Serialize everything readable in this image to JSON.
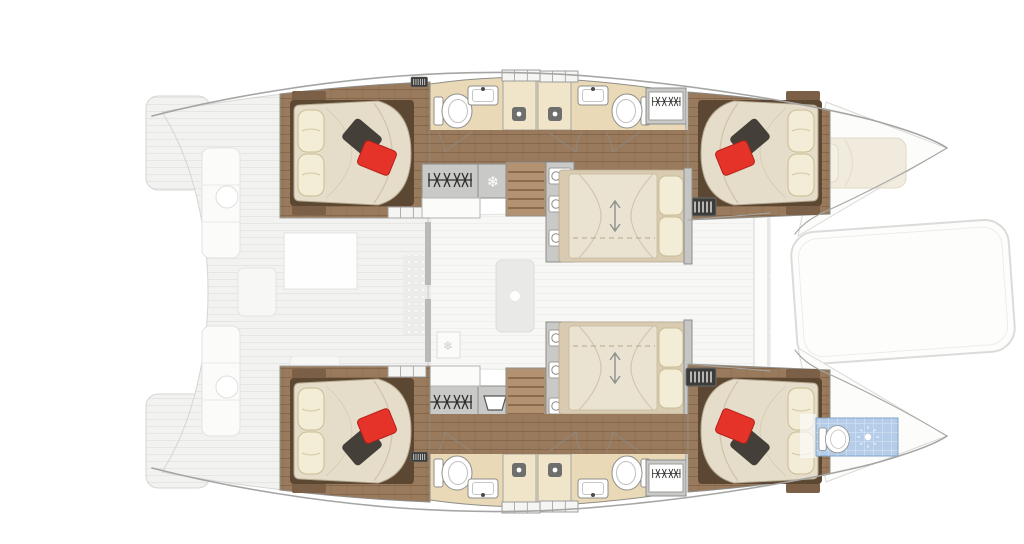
{
  "scene": {
    "type": "floorplan",
    "subject": "catamaran sailing yacht - overhead interior and deck layout plan",
    "orientation": "bow-right",
    "visible_inventory": {
      "double_cabins": 4,
      "accent_pillows_per_cabin": 2,
      "bathrooms": 4,
      "shower_stalls": 4,
      "toilets": 5,
      "sinks": 4,
      "center_berths": 2,
      "staircases": 2,
      "wardrobe_hanger_lockers": 4,
      "bow_berth": 1,
      "bow_wet_room": 1
    }
  },
  "icons": {
    "snowflake": "❄"
  },
  "colors": {
    "background": "#ffffff",
    "deck_fill": "#f2f2f1",
    "deck_fill_light": "#f7f7f6",
    "deck_stroke": "#d6d6d4",
    "deck_furniture": "#fbfbfa",
    "hull_outline": "#a5a5a3",
    "wall_gray": "#8d8d8b",
    "wood_floor": "#9a7a5c",
    "wood_mid": "#7b5f46",
    "wood_dark": "#5c4733",
    "stair_wood": "#b29271",
    "bathroom_floor": "#e9d9b7",
    "shower_floor": "#f0e5c9",
    "unit_gray": "#c9c9c7",
    "counter_white": "#fbfbfa",
    "mattress": "#e5ddca",
    "mattress_shade": "#cfc2a8",
    "pillow_cream": "#f3edd8",
    "pillow_border": "#c9bd92",
    "pillow_red": "#e5332a",
    "pillow_dark": "#453f3a",
    "pale_bed": "#eae3d2",
    "pale_frame": "#d8cbb2",
    "blue_floor": "#b5cde8",
    "blue_stroke": "#7fa3c8",
    "fixture_white": "#ffffff",
    "fixture_stroke": "#8f8f8d",
    "icon_dark": "#2e2e2c"
  }
}
